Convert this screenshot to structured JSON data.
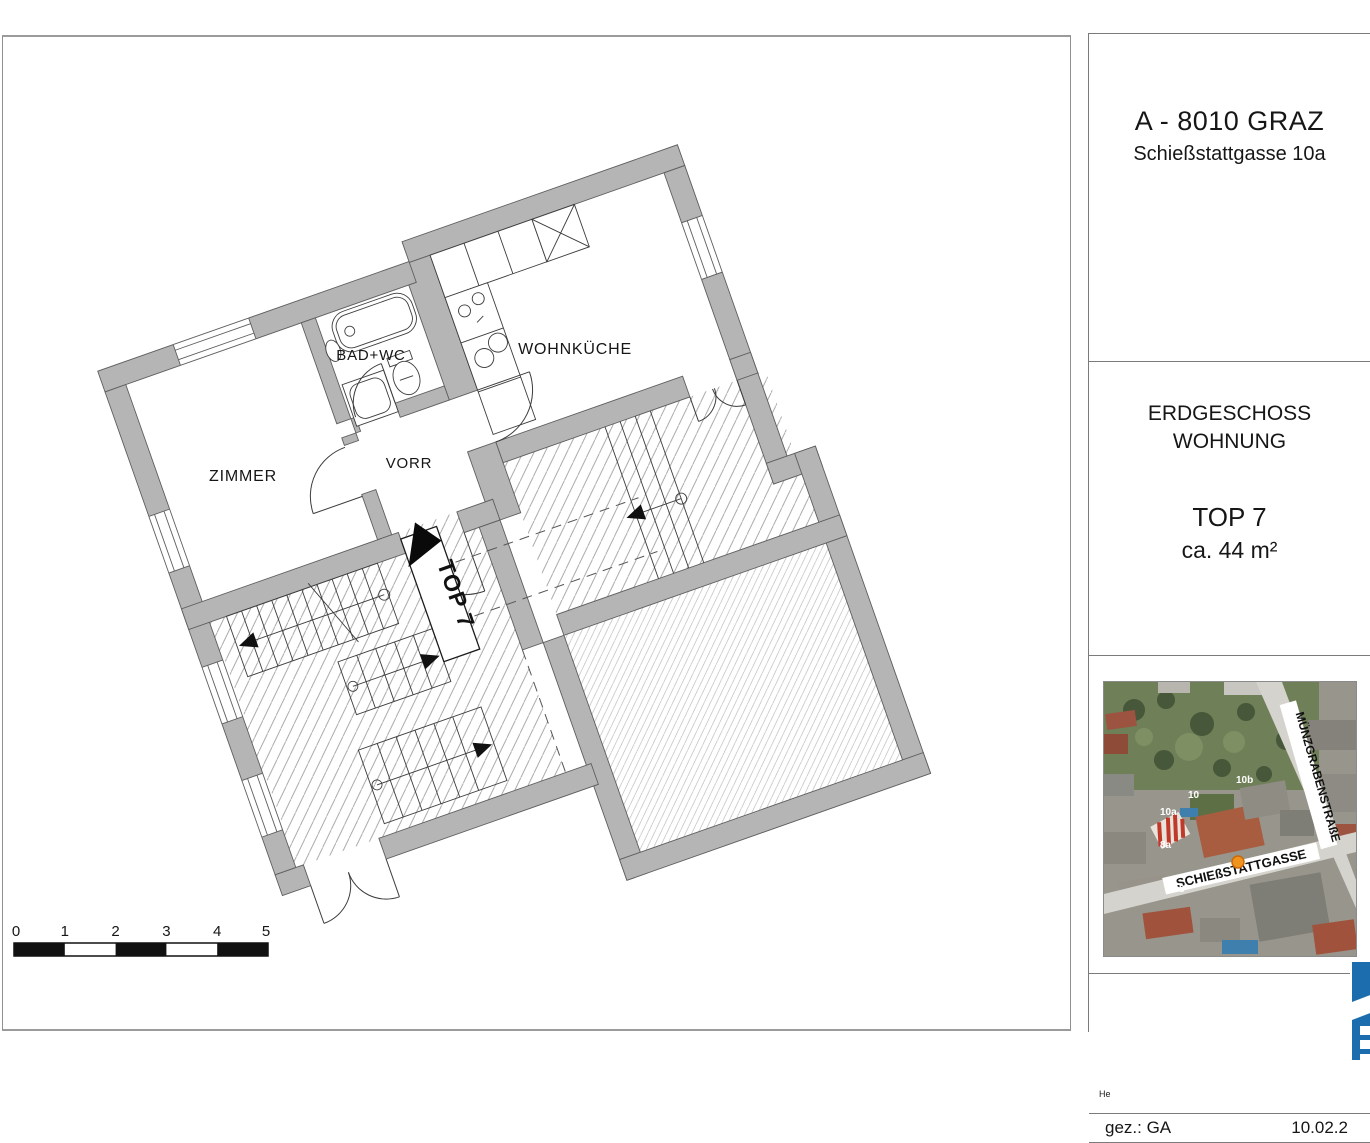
{
  "title_block": {
    "address_line1": "A - 8010 GRAZ",
    "address_line2": "Schießstattgasse 10a",
    "floor_line1": "ERDGESCHOSS",
    "floor_line2": "WOHNUNG",
    "unit": "TOP 7",
    "area": "ca. 44 m²",
    "note": "He",
    "drawn_by": "gez.: GA",
    "date": "10.02.2"
  },
  "plan": {
    "rooms": [
      {
        "name": "ZIMMER"
      },
      {
        "name": "BAD+WC"
      },
      {
        "name": "VORR"
      },
      {
        "name": "WOHNKÜCHE"
      }
    ],
    "unit_flag": "TOP 7",
    "wall_color": "#b5b5b5"
  },
  "scale_bar": {
    "labels": [
      "0",
      "1",
      "2",
      "3",
      "4",
      "5"
    ]
  },
  "map": {
    "streets": [
      "SCHIEßSTATTGASSE",
      "MÜNZGRABENSTRAßE"
    ],
    "house_numbers": [
      "10b",
      "10",
      "10a",
      "8a",
      "8"
    ],
    "marker_color": "#f0941e"
  },
  "logo": {
    "color": "#1c6dad"
  }
}
